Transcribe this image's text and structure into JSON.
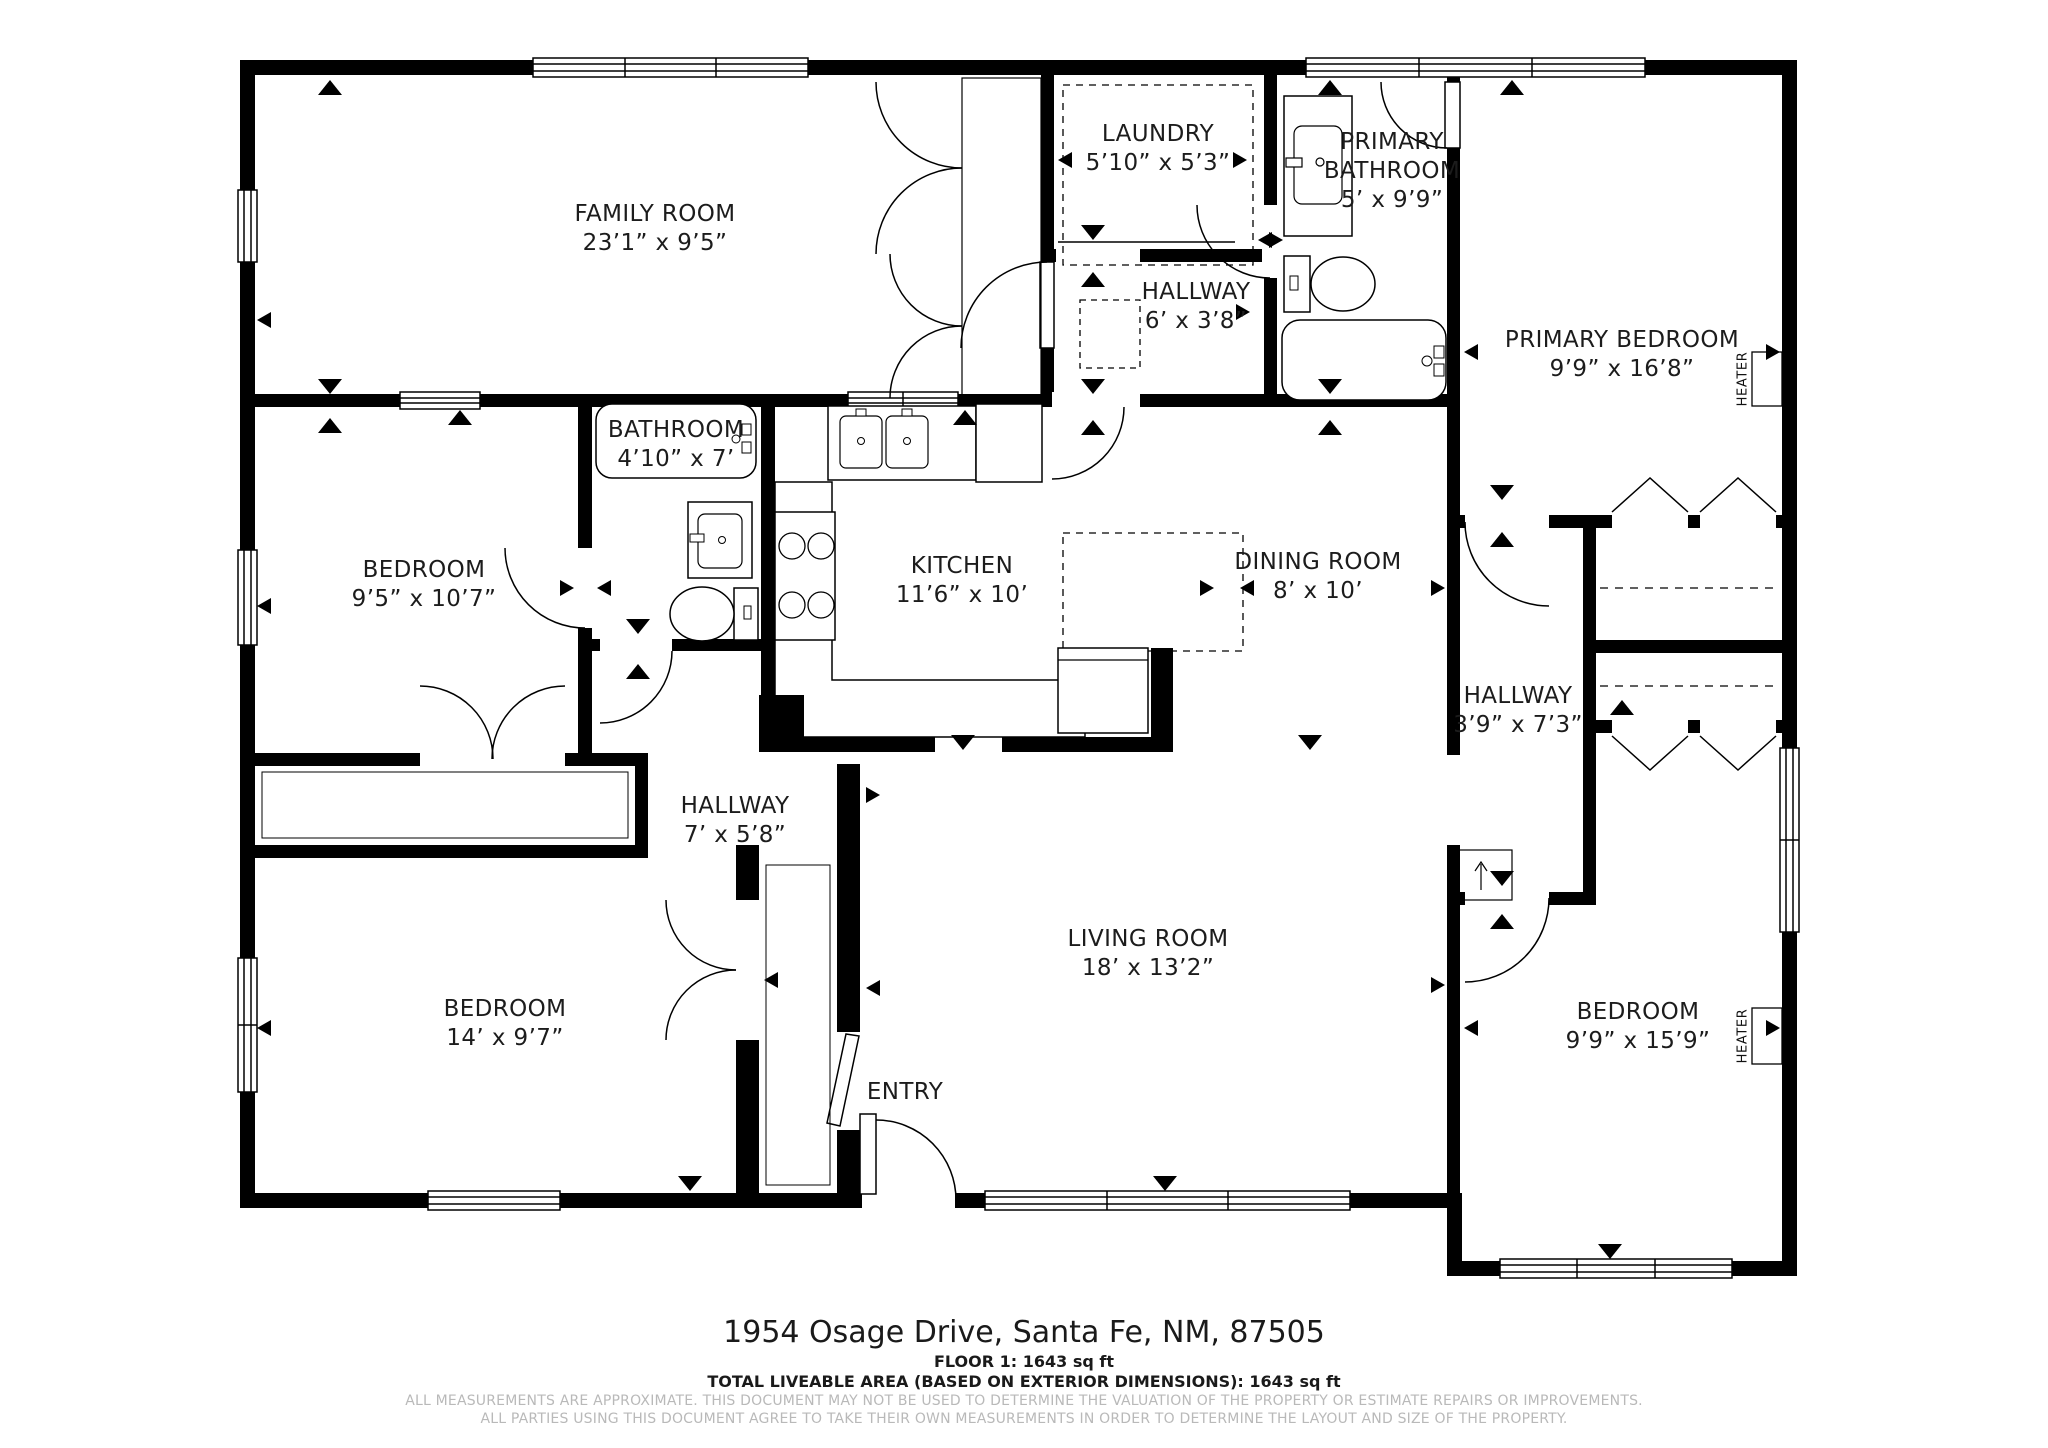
{
  "rooms": {
    "family_room": {
      "name": "FAMILY ROOM",
      "dims": "23’1” x 9’5”"
    },
    "laundry": {
      "name": "LAUNDRY",
      "dims": "5’10” x 5’3”"
    },
    "hallway_upper": {
      "name": "HALLWAY",
      "dims": "6’ x 3’8”"
    },
    "primary_bathroom": {
      "name": "PRIMARY BATHROOM",
      "dims": "5’ x 9’9”"
    },
    "primary_bedroom": {
      "name": "PRIMARY BEDROOM",
      "dims": "9’9” x 16’8”"
    },
    "bedroom_left": {
      "name": "BEDROOM",
      "dims": "9’5” x 10’7”"
    },
    "bathroom": {
      "name": "BATHROOM",
      "dims": "4’10” x 7’"
    },
    "kitchen": {
      "name": "KITCHEN",
      "dims": "11’6” x 10’"
    },
    "dining_room": {
      "name": "DINING ROOM",
      "dims": "8’ x 10’"
    },
    "hallway_wing": {
      "name": "HALLWAY",
      "dims": "3’9” x 7’3”"
    },
    "hallway_center": {
      "name": "HALLWAY",
      "dims": "7’ x 5’8”"
    },
    "bedroom_lower_left": {
      "name": "BEDROOM",
      "dims": "14’ x 9’7”"
    },
    "living_room": {
      "name": "LIVING ROOM",
      "dims": "18’ x 13’2”"
    },
    "entry": {
      "name": "ENTRY"
    },
    "bedroom_lower_right": {
      "name": "BEDROOM",
      "dims": "9’9” x 15’9”"
    }
  },
  "labels": {
    "heater": "HEATER"
  },
  "footer": {
    "address": "1954 Osage Drive, Santa Fe, NM, 87505",
    "floor_line": "FLOOR 1: 1643 sq ft",
    "total_line": "TOTAL LIVEABLE AREA (BASED ON EXTERIOR DIMENSIONS): 1643 sq ft",
    "disclaimer1": "ALL MEASUREMENTS ARE APPROXIMATE. THIS DOCUMENT MAY NOT BE USED TO DETERMINE THE VALUATION OF THE PROPERTY OR ESTIMATE REPAIRS OR IMPROVEMENTS.",
    "disclaimer2": "ALL PARTIES USING THIS DOCUMENT AGREE TO TAKE THEIR OWN MEASUREMENTS IN ORDER TO DETERMINE THE LAYOUT AND SIZE OF THE PROPERTY."
  },
  "colors": {
    "wall": "#000000",
    "background": "#ffffff",
    "disclaimer_gray": "#b9b9b9"
  }
}
